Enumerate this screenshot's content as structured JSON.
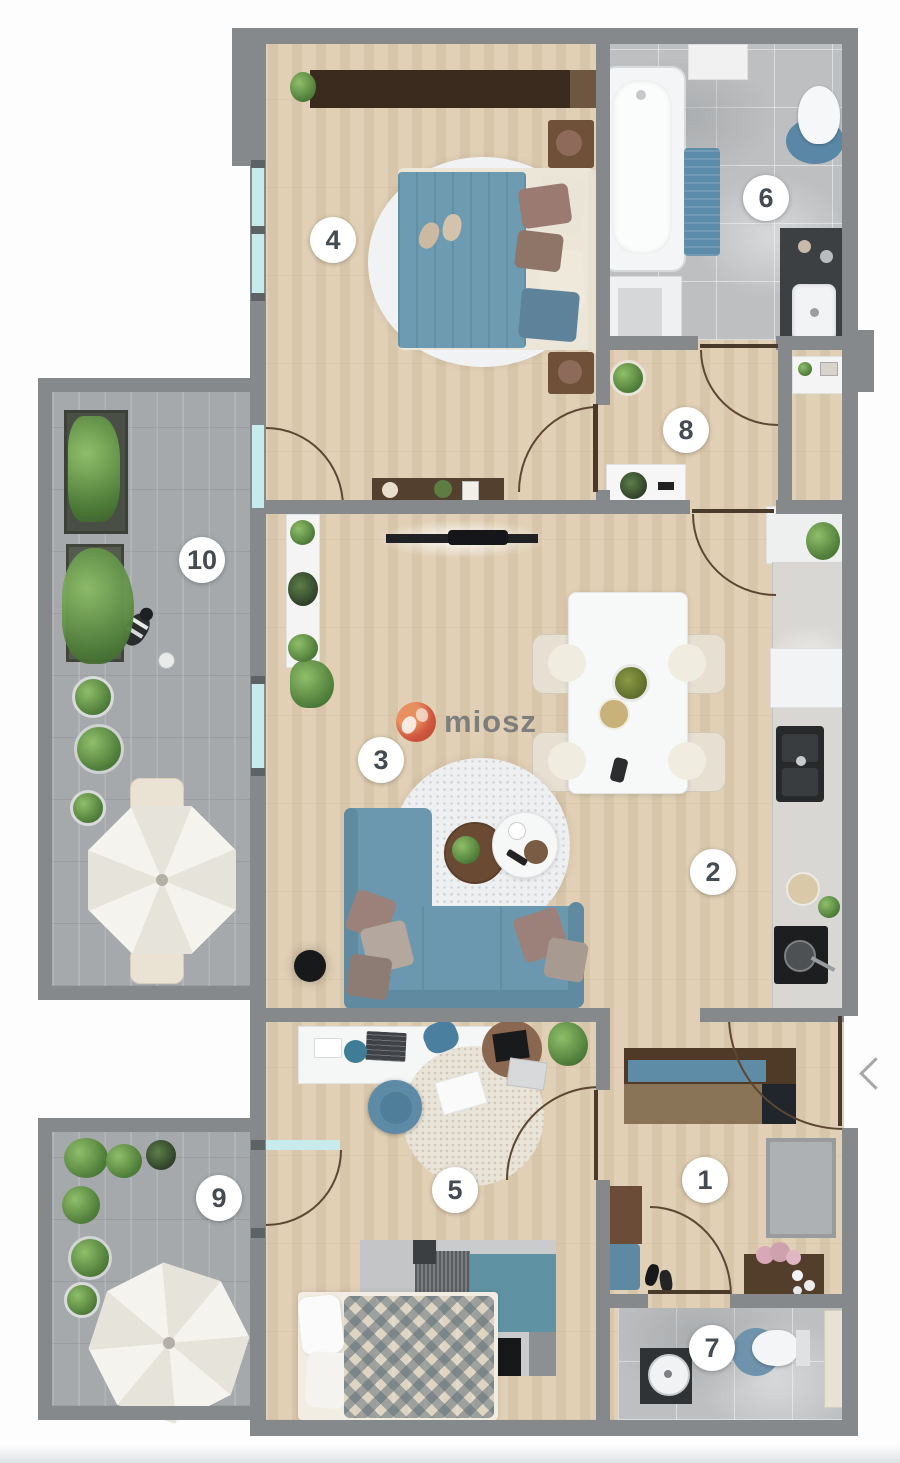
{
  "watermark": {
    "text": "miosz"
  },
  "carousel": {
    "prev_icon": "chevron-left"
  },
  "rooms": [
    {
      "number": "1"
    },
    {
      "number": "2"
    },
    {
      "number": "3"
    },
    {
      "number": "4"
    },
    {
      "number": "5"
    },
    {
      "number": "6"
    },
    {
      "number": "7"
    },
    {
      "number": "8"
    },
    {
      "number": "9"
    },
    {
      "number": "10"
    }
  ],
  "colors": {
    "wall": "#86898c",
    "wood_floor": "#e1d0b5",
    "terrace_paver": "#a5a9ac",
    "bathroom_tile": "#bdbfc1",
    "accent_blue": "#6b98ae",
    "dark_wood": "#4f3a28",
    "window_glass": "#c7ebec",
    "badge_text": "#454b52",
    "watermark_red": "#cf4a33",
    "watermark_grey": "#747678"
  }
}
